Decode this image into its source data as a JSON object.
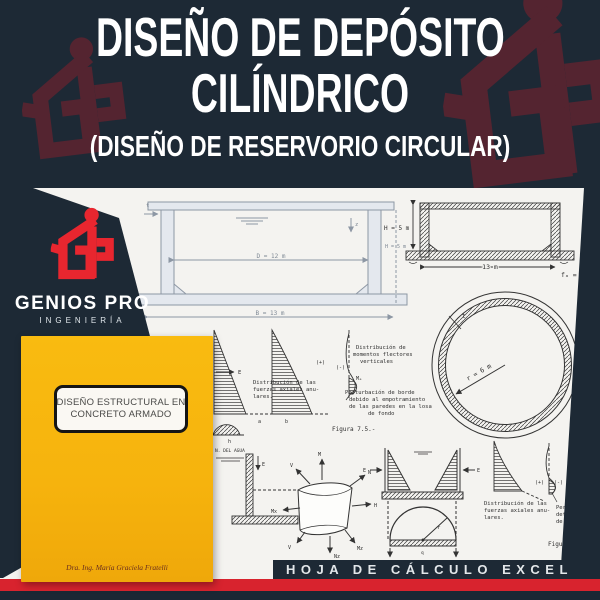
{
  "header": {
    "title_line1": "DISEÑO DE DEPÓSITO",
    "title_line2": "CILÍNDRICO",
    "subtitle": "(DISEÑO DE RESERVORIO CIRCULAR)"
  },
  "brand": {
    "name": "GENIOS PRO",
    "tagline": "INGENIERÍA"
  },
  "book": {
    "title_line1": "DISEÑO ESTRUCTURAL EN",
    "title_line2": "CONCRETO  ARMADO",
    "author": "Dra. Ing.  María Graciela Fratelli"
  },
  "footer": {
    "banner": "HOJA DE CÁLCULO EXCEL"
  },
  "diagrams": {
    "tank_section": {
      "diameter": "D = 12 m",
      "base": "B = 13 m",
      "height": "H = 5 m",
      "depth_var": "z",
      "thickness": "t"
    },
    "sketch_section": {
      "height": "H = 5 m",
      "width": "13 m",
      "stress": "fₐ = f"
    },
    "plan_circle": {
      "radius": "r = 6 m",
      "thickness": "t"
    },
    "annotations": {
      "axial_1": [
        "Distribución de las",
        "fuerzas axiales anu-",
        "lares."
      ],
      "moments": [
        "Distribución de",
        "momentos flectores",
        "verticales"
      ],
      "edge": [
        "Perturbación de borde",
        "debido al empotramiento",
        "de las paredes en la losa",
        "de fondo"
      ],
      "figure_1": "Figura 7.5.-",
      "water": "N. DEL AGUA",
      "axial_2": [
        "Distribución de las",
        "fuerzas axiales anu-",
        "lares."
      ],
      "edge_2": [
        "Per",
        "det",
        "de"
      ],
      "figure_2": "Figura",
      "plus": "(+)",
      "minus": "(-)",
      "label_e": "E",
      "label_r": "r",
      "label_h": "h",
      "label_a": "a",
      "label_b": "b",
      "label_me": "Mₑ",
      "label_q": "q",
      "label_mx2": "Mx",
      "shell": [
        "V",
        "M",
        "N",
        "H",
        "Mx",
        "Nz",
        "Mz",
        "V"
      ]
    }
  },
  "colors": {
    "navy": "#1d2935",
    "maroon": "#542430",
    "brand_red": "#e8262f",
    "book_yellow": "#f6b30d",
    "strip_red": "#d8232e",
    "paper": "#f4f3f0"
  }
}
